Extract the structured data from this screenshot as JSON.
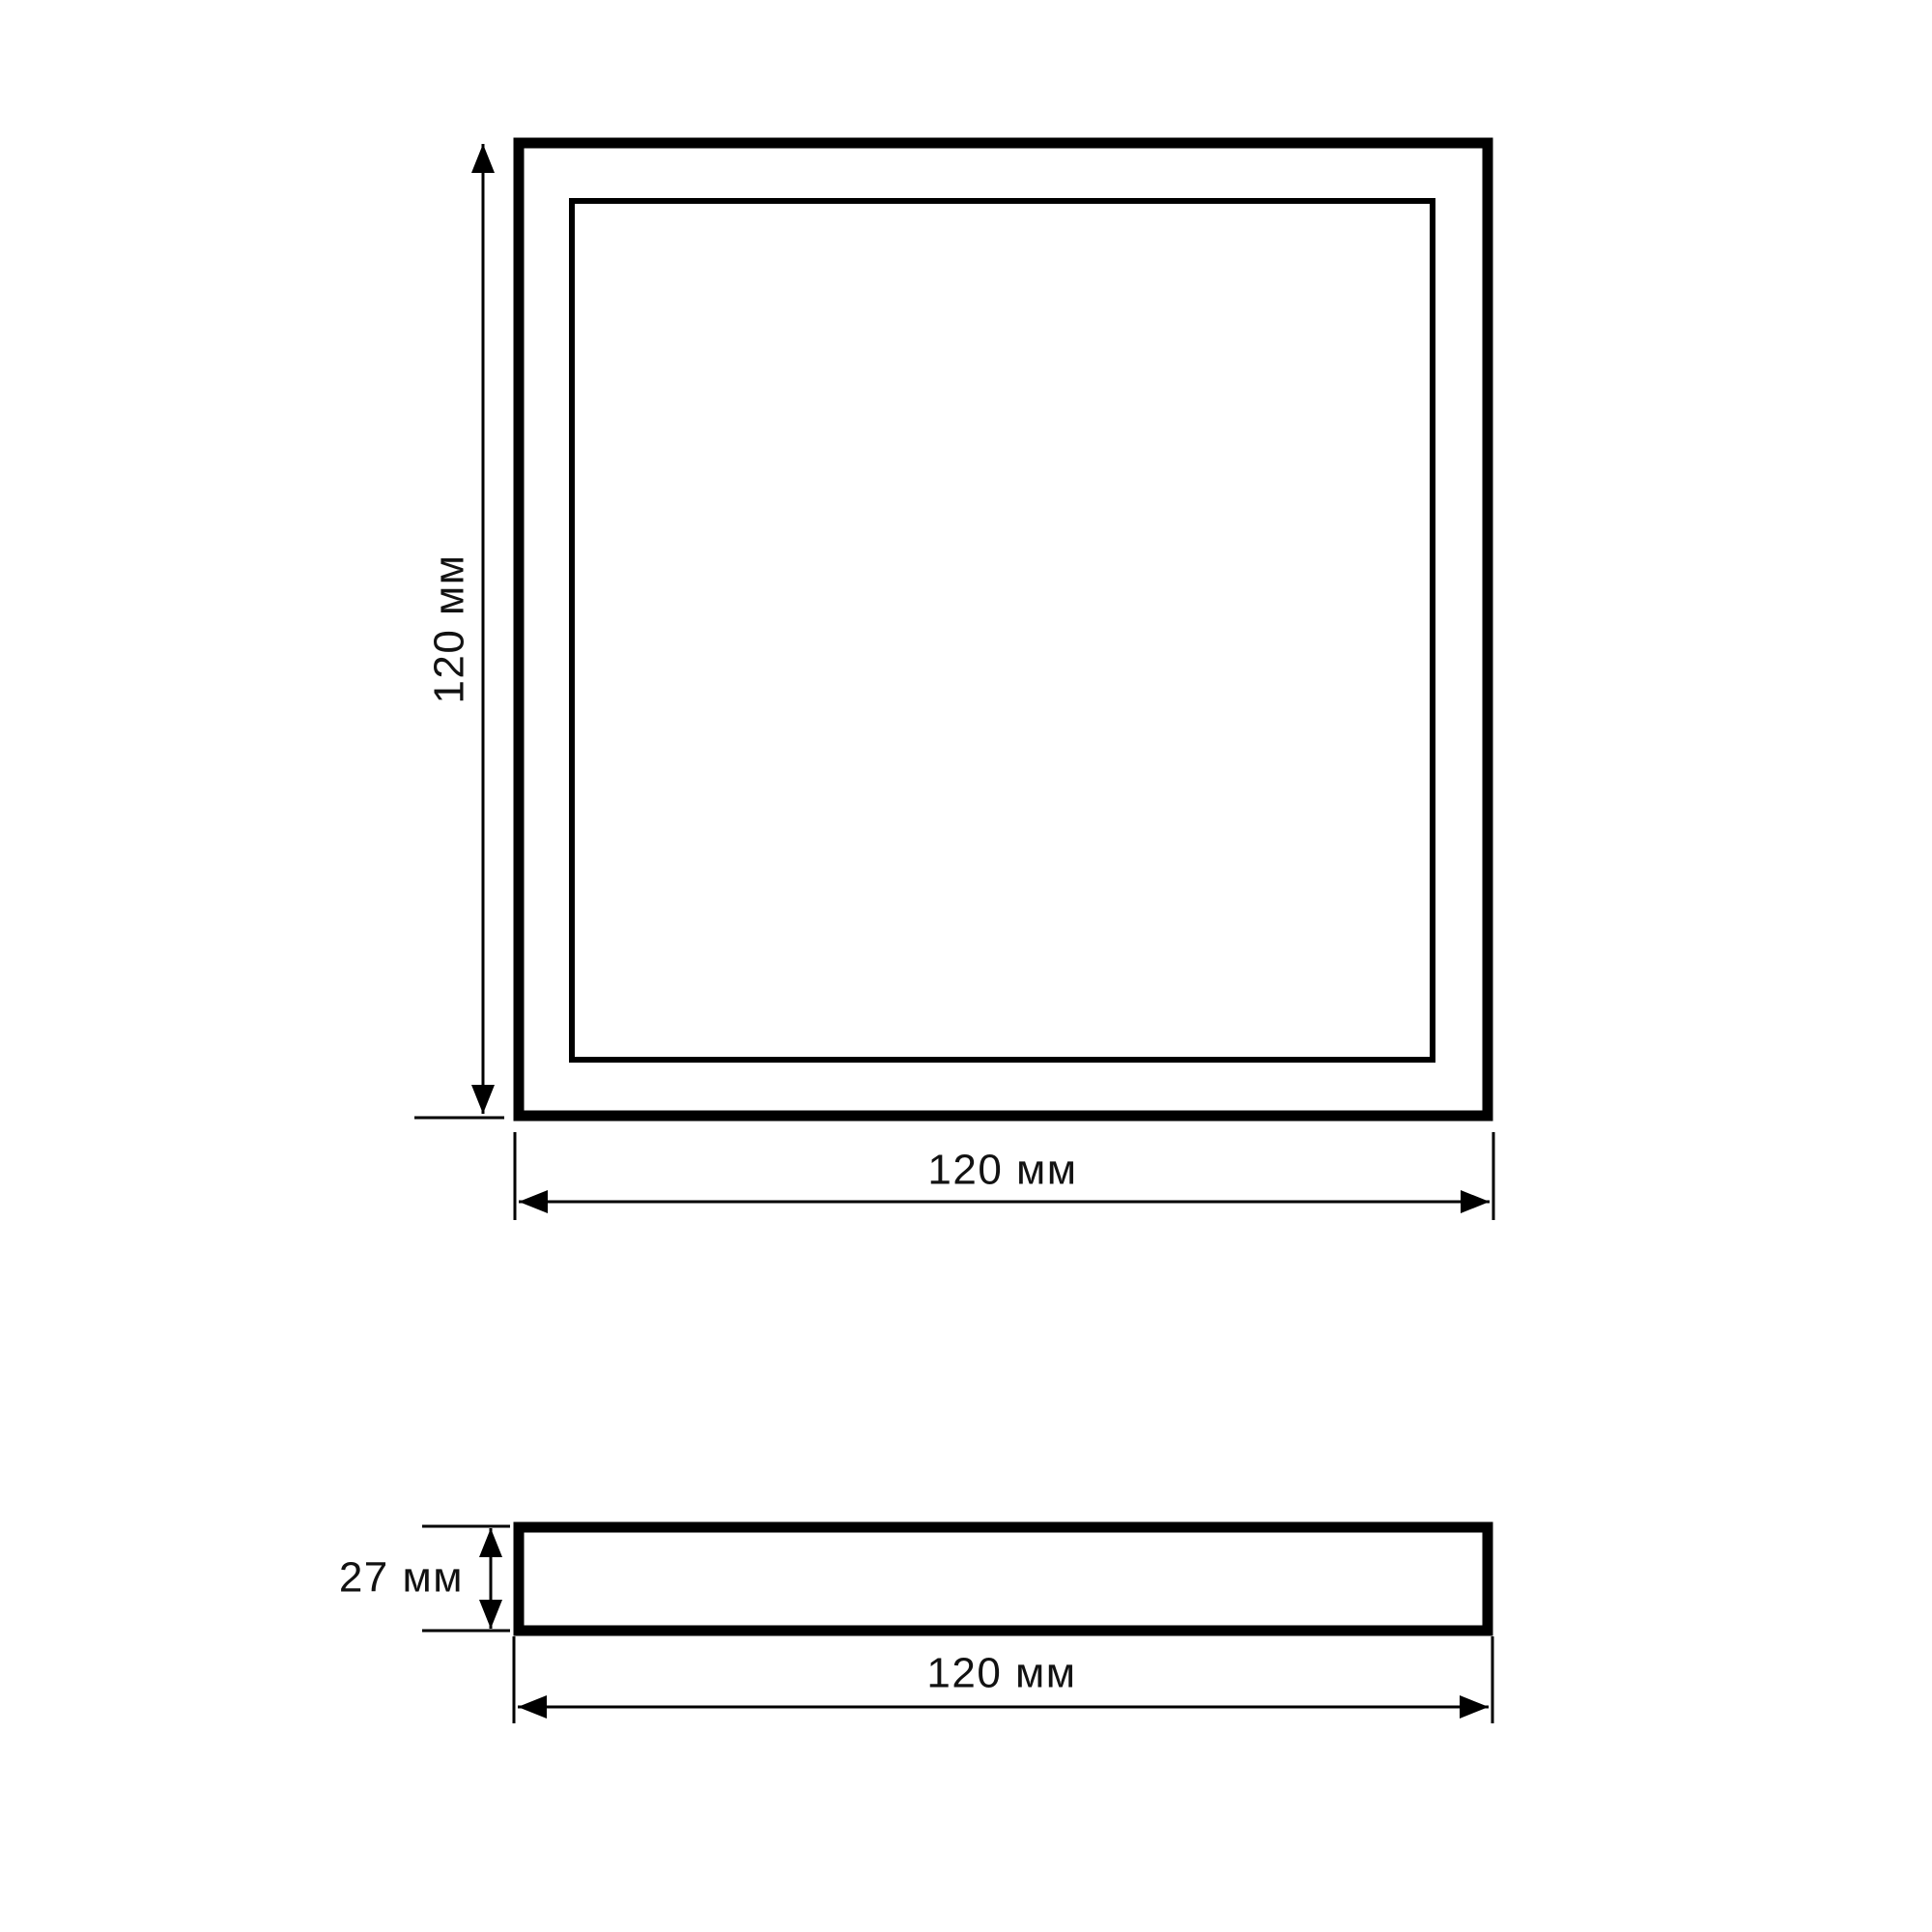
{
  "colors": {
    "line": "#000000",
    "text": "#121212",
    "background": "#ffffff"
  },
  "drawing": {
    "top_view": {
      "height_label": "120 мм",
      "width_label": "120 мм"
    },
    "side_view": {
      "height_label": "27 мм",
      "width_label": "120 мм"
    }
  }
}
